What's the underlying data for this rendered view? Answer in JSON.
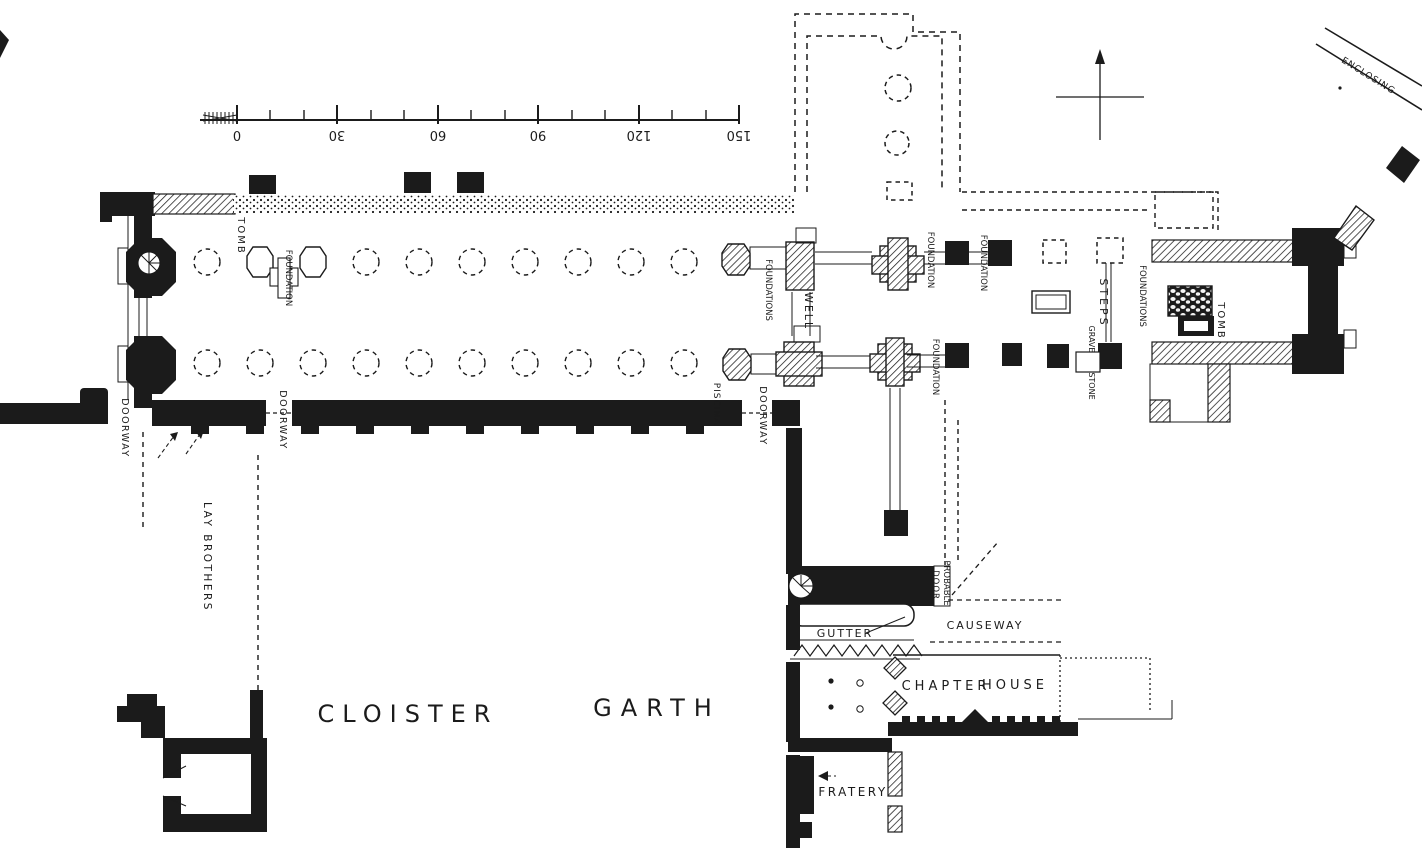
{
  "figure": {
    "type": "abbey-ground-plan"
  },
  "colors": {
    "ink": "#1b1b1b",
    "paper": "#ffffff"
  },
  "scale_bar": {
    "ticks": [
      "0",
      "30",
      "60",
      "90",
      "120",
      "150"
    ]
  },
  "labels": {
    "enclosing": "ENCLOSING",
    "tomb_west": "TOMB",
    "foundation_nave": "FOUNDATION",
    "doorway_west": "DOORWAY",
    "doorway_nave": "DOORWAY",
    "lay_brothers": "LAY  BROTHERS",
    "piscina": "PISCINA",
    "foundations_crossing": "FOUNDATIONS",
    "well": "WELL",
    "doorway_crossing": "DOORWAY",
    "foundation_ne": "FOUNDATION",
    "foundation_choir": "FOUNDATION",
    "foundation_se": "FOUNDATION",
    "steps": "STEPS",
    "grave": "GRAVE",
    "stone": "STONE",
    "foundations_presbytery": "FOUNDATIONS",
    "tomb_east": "TOMB",
    "probable": "PROBABLE",
    "door": "DOOR",
    "causeway": "CAUSEWAY",
    "gutter": "GUTTER",
    "chapter": "CHAPTER",
    "house": "HOUSE",
    "fratery": "FRATERY",
    "cloister": "CLOISTER",
    "garth": "GARTH"
  }
}
